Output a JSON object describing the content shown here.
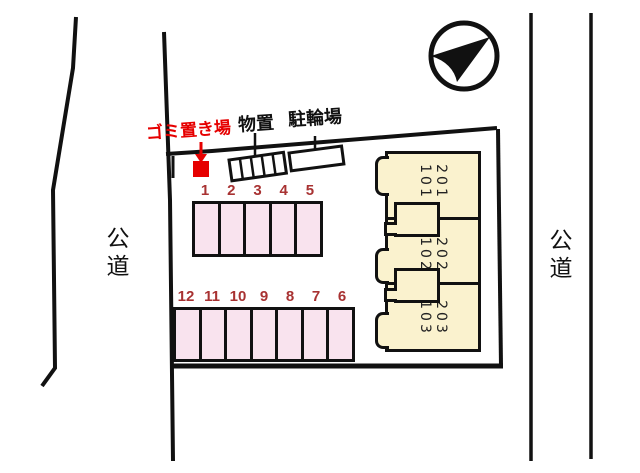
{
  "plan": {
    "type": "site-plan",
    "roads": {
      "left": "公道",
      "right": "公道"
    },
    "labels": {
      "garbage_area": "ゴミ置き場",
      "storage_shed": "物置",
      "bicycle_parking": "駐輪場"
    },
    "parking": {
      "upper_row": [
        "1",
        "2",
        "3",
        "4",
        "5"
      ],
      "lower_row": [
        "12",
        "11",
        "10",
        "9",
        "8",
        "7",
        "6"
      ]
    },
    "building": {
      "units": [
        {
          "line1": "201",
          "line2": "101"
        },
        {
          "line1": "202",
          "line2": "102"
        },
        {
          "line1": "203",
          "line2": "103"
        }
      ]
    },
    "icons": {
      "north_arrow": "compass-north-arrow",
      "garbage_pointer": "red-down-arrow",
      "garbage_marker": "red-square"
    },
    "colors": {
      "accent_red": "#e60000",
      "stall_number_red": "#a83232",
      "stall_pink": "#f9e3ee",
      "unit_cream": "#faf2ce",
      "line_black": "#111111"
    }
  }
}
